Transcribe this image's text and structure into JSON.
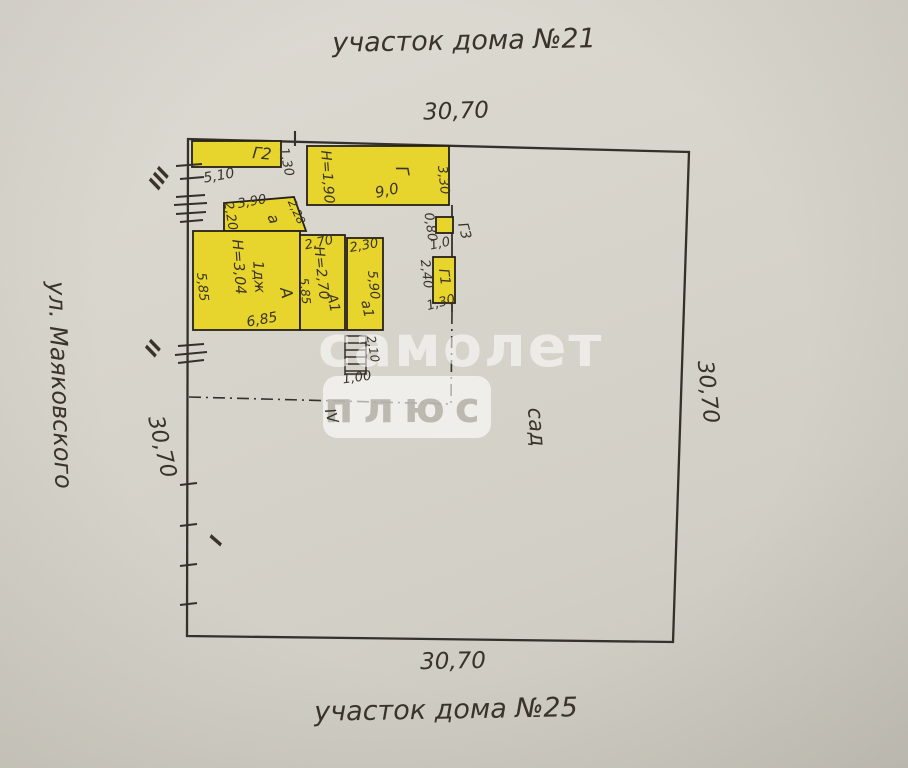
{
  "page": {
    "top_plot_label": "участок дома №21",
    "bottom_plot_label": "участок дома №25",
    "street_label": "ул. Маяковского",
    "garden_label": "сад"
  },
  "dimensions": {
    "top": "30,70",
    "bottom": "30,70",
    "left": "30,70",
    "right": "30,70"
  },
  "buildings": {
    "g2": {
      "label": "Г2",
      "dim_bottom": "5,10",
      "dim_right": "1,30"
    },
    "g": {
      "label": "Г",
      "height": "Н=1,90",
      "area": "9,0",
      "dim_right": "3,30"
    },
    "g3": {
      "label": "Г3",
      "dim_left": "0,80",
      "dim_bottom": "1,0"
    },
    "g1": {
      "label": "Г1",
      "dim_left": "2,40",
      "dim_bottom": "1,30"
    },
    "a_porch": {
      "label": "а",
      "dim_top": "3,90",
      "dim_left": "2,20",
      "dim_right": "2,28"
    },
    "a_main": {
      "label": "А",
      "type": "1дж",
      "height": "Н=3,04",
      "dim_left": "5,85",
      "dim_bottom": "6,85"
    },
    "a1": {
      "label": "А1",
      "dim_top": "2,70",
      "height": "Н=2,70",
      "dim_right": "5,85"
    },
    "a1_porch": {
      "label": "а1",
      "dim_top": "2,30",
      "dim_right": "5,90"
    },
    "steps": {
      "dim_right": "2,10",
      "dim_bottom": "1,00"
    }
  },
  "boundary_markers": {
    "i": "I",
    "ii": "II",
    "iii": "III",
    "iv": "IV"
  },
  "watermark": {
    "word1": "самолет",
    "word2": "плюс"
  },
  "colors": {
    "paper": "#d6d3ca",
    "ink": "#3a332a",
    "line": "#35302a",
    "building_fill": "#e7d42c",
    "building_stroke": "#26211a"
  }
}
